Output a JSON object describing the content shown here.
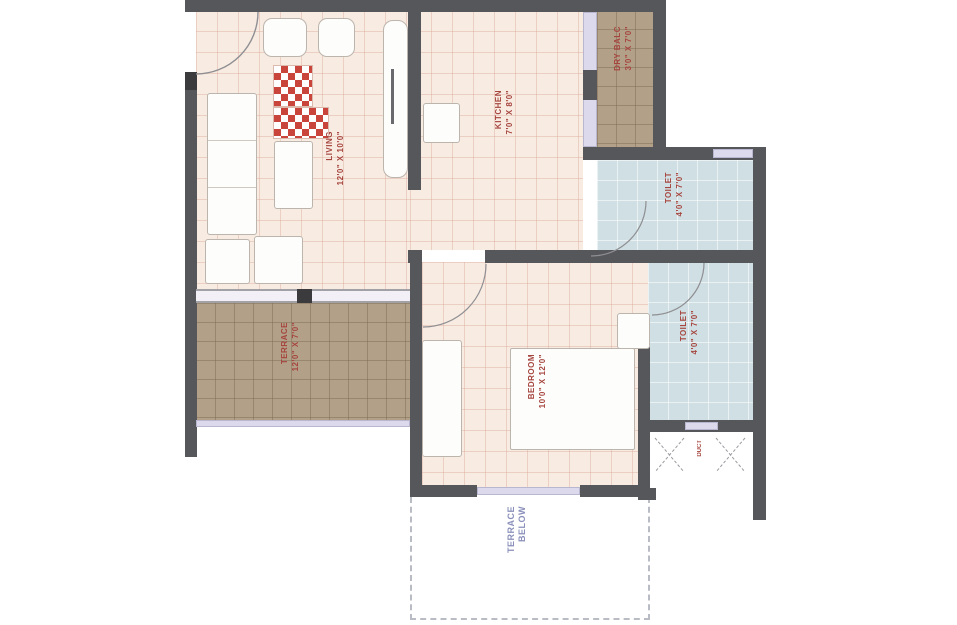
{
  "plan": {
    "title": "1BHK apartment floor plan",
    "rooms": {
      "living": {
        "name": "LIVING",
        "dims": "12'0\" X 10'0\""
      },
      "kitchen": {
        "name": "KITCHEN",
        "dims": "7'0\" X 8'0\""
      },
      "dry_balcony": {
        "name": "DRY BALC",
        "dims": "3'0\" X 7'0\""
      },
      "toilet1": {
        "name": "TOILET",
        "dims": "4'0\" X 7'0\""
      },
      "toilet2": {
        "name": "TOILET",
        "dims": "4'0\" X 7'0\""
      },
      "bedroom": {
        "name": "BEDROOM",
        "dims": "10'0\" X 12'0\""
      },
      "terrace": {
        "name": "TERRACE",
        "dims": "12'0\" X 7'0\""
      },
      "duct": {
        "name": "DUCT"
      },
      "terrace_below": {
        "name": "TERRACE",
        "dims": "BELOW"
      }
    },
    "colors": {
      "wall": "#56575a",
      "floor_tile": "#f8ebe2",
      "terrace_tile": "#b2a088",
      "toilet_floor": "#cfdfe3",
      "window_strip": "#dcd9ec",
      "room_label_red": "#a6453e",
      "outside_label_blue": "#8a90bb",
      "rug_checker_red": "#c9453c",
      "background": "#ffffff"
    }
  }
}
